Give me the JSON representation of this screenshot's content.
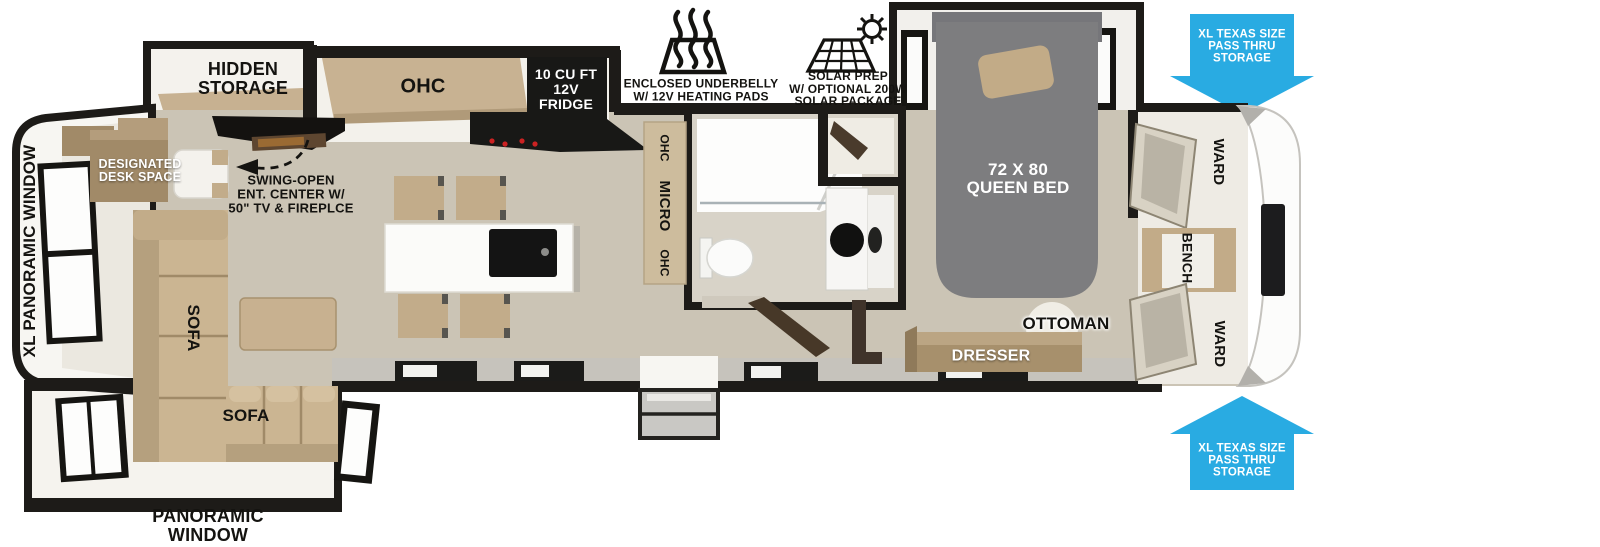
{
  "floorplan": {
    "labels": {
      "hidden_storage": "HIDDEN\nSTORAGE",
      "ohc_kitchen": "OHC",
      "fridge": "10 CU FT\n12V\nFRIDGE",
      "underbelly": "ENCLOSED UNDERBELLY\nW/ 12V HEATING PADS",
      "solar": "SOLAR PREP\nW/ OPTIONAL 200W\nSOLAR PACKAGE",
      "queen_bed": "72 X 80\nQUEEN BED",
      "pass_thru": "XL TEXAS SIZE\nPASS THRU\nSTORAGE",
      "ward": "WARD",
      "bench": "BENCH",
      "ottoman": "OTTOMAN",
      "dresser": "DRESSER",
      "ohc": "OHC",
      "micro": "MICRO",
      "xl_panoramic_window": "XL PANORAMIC WINDOW",
      "designated_desk": "DESIGNATED\nDESK SPACE",
      "swing_open": "SWING-OPEN\nENT. CENTER W/\n50\" TV & FIREPLCE",
      "sofa": "SOFA",
      "panoramic_window": "PANORAMIC\nWINDOW"
    },
    "colors": {
      "arrow_blue": "#29abe2",
      "wall_black": "#1d1b18",
      "floor_tan": "#cbc4b5",
      "cabinet_tan": "#c7b191",
      "bed_gray": "#7d7d7f"
    }
  }
}
